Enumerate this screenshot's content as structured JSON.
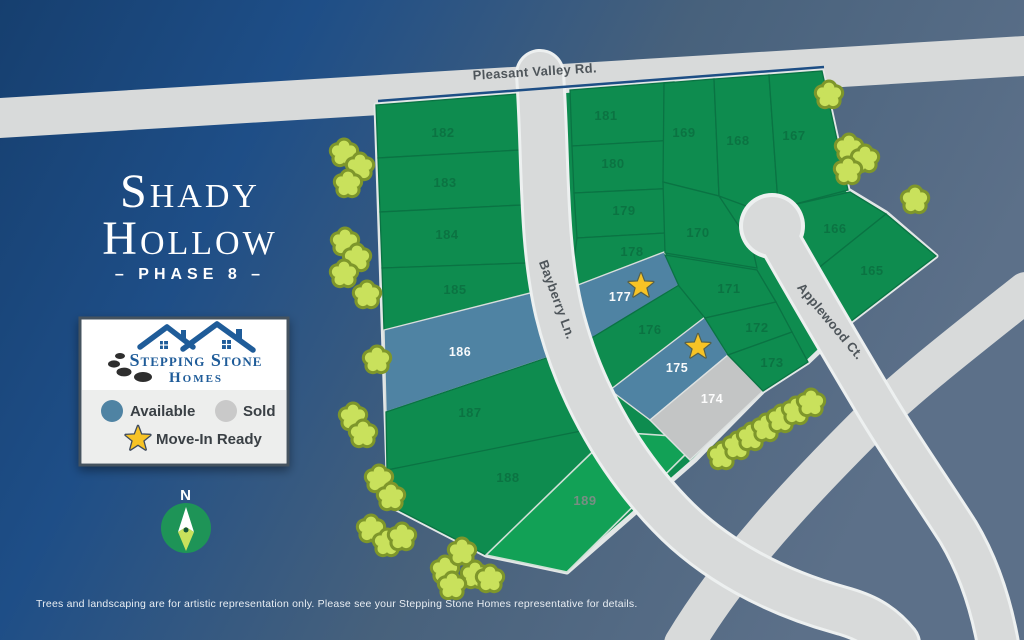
{
  "title": {
    "line1": "Shady",
    "line2": "Hollow",
    "phase": "– PHASE 8 –"
  },
  "logo": {
    "name_line1": "Stepping Stone",
    "name_line2": "Homes"
  },
  "legend": {
    "available_label": "Available",
    "sold_label": "Sold",
    "move_in_label": "Move-In Ready",
    "colors": {
      "available": "#4F83A3",
      "sold": "#C9C9C9",
      "star": "#F7C325",
      "standard_lot": "#0E8C4F"
    }
  },
  "compass": {
    "label": "N"
  },
  "roads": {
    "pleasant_valley": "Pleasant Valley Rd.",
    "bayberry": "Bayberry Ln.",
    "applewood": "Applewood Ct."
  },
  "map": {
    "lots": [
      {
        "number": "182",
        "status": "standard"
      },
      {
        "number": "183",
        "status": "standard"
      },
      {
        "number": "184",
        "status": "standard"
      },
      {
        "number": "185",
        "status": "standard"
      },
      {
        "number": "186",
        "status": "available"
      },
      {
        "number": "187",
        "status": "standard"
      },
      {
        "number": "188",
        "status": "standard"
      },
      {
        "number": "189",
        "status": "standard"
      },
      {
        "number": "181",
        "status": "standard"
      },
      {
        "number": "180",
        "status": "standard"
      },
      {
        "number": "179",
        "status": "standard"
      },
      {
        "number": "178",
        "status": "standard"
      },
      {
        "number": "177",
        "status": "available",
        "move_in_ready": true
      },
      {
        "number": "176",
        "status": "standard"
      },
      {
        "number": "175",
        "status": "available",
        "move_in_ready": true
      },
      {
        "number": "174",
        "status": "sold"
      },
      {
        "number": "169",
        "status": "standard"
      },
      {
        "number": "168",
        "status": "standard"
      },
      {
        "number": "167",
        "status": "standard"
      },
      {
        "number": "170",
        "status": "standard"
      },
      {
        "number": "171",
        "status": "standard"
      },
      {
        "number": "172",
        "status": "standard"
      },
      {
        "number": "173",
        "status": "standard"
      },
      {
        "number": "166",
        "status": "standard"
      },
      {
        "number": "165",
        "status": "standard"
      }
    ]
  },
  "disclaimer": "Trees and landscaping are for artistic representation only. Please see your Stepping Stone Homes representative for details."
}
